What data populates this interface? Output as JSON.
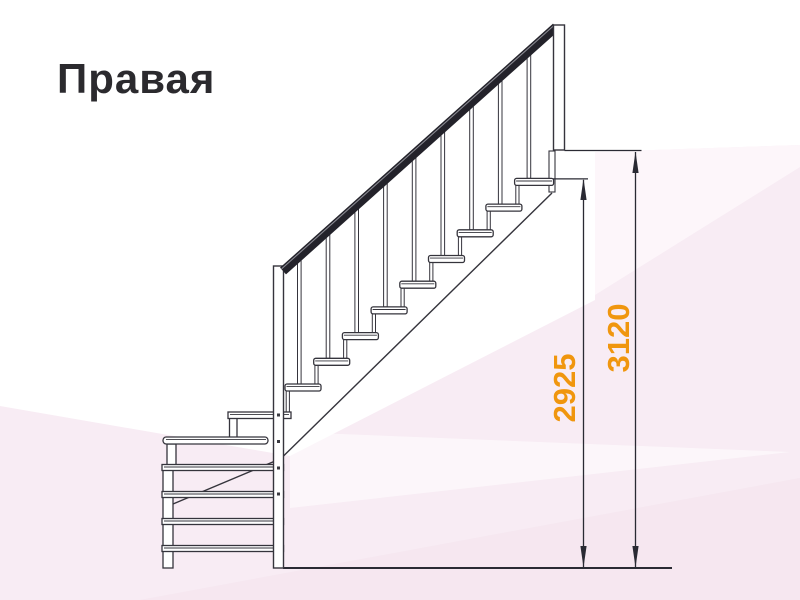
{
  "title": "Правая",
  "diagram": {
    "type": "staircase-side-elevation-right",
    "dimensions": [
      {
        "id": "floor_to_landing",
        "value": "2925"
      },
      {
        "id": "floor_to_top",
        "value": "3120"
      }
    ]
  },
  "colors": {
    "dimension_label": "#F0960E",
    "outline": "#35343C",
    "handrail": "#23222A",
    "background_tint": "#F8ECF4"
  }
}
